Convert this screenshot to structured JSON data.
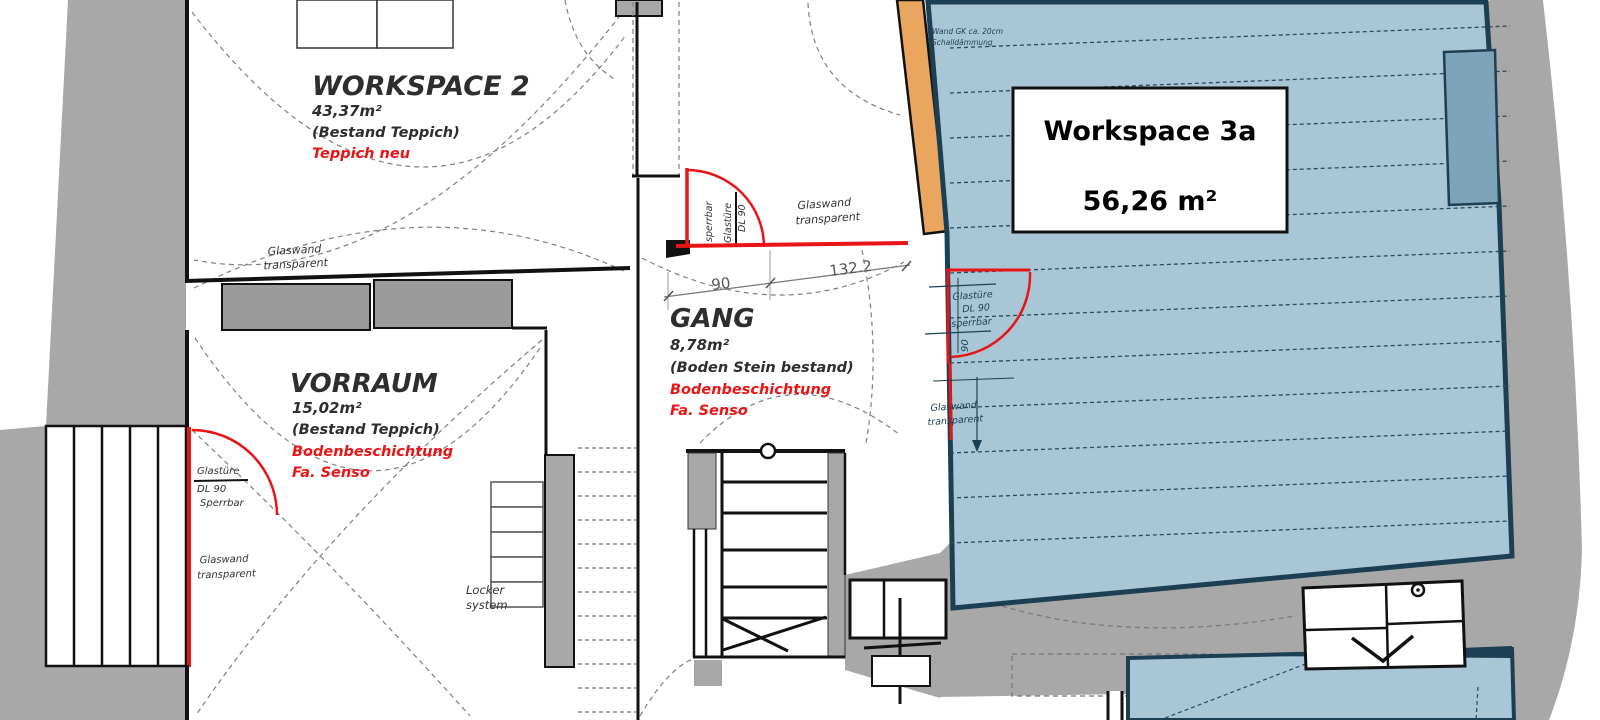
{
  "plan": {
    "rooms": {
      "workspace2": {
        "name": "WORKSPACE 2",
        "area": "43,37m²",
        "floor_existing": "(Bestand Teppich)",
        "floor_new": "Teppich neu"
      },
      "vorraum": {
        "name": "VORRAUM",
        "area": "15,02m²",
        "floor_existing": "(Bestand Teppich)",
        "floor_new1": "Bodenbeschichtung",
        "floor_new2": "Fa. Senso"
      },
      "gang": {
        "name": "GANG",
        "area": "8,78m²",
        "floor_existing": "(Boden Stein bestand)",
        "floor_new1": "Bodenbeschichtung",
        "floor_new2": "Fa. Senso"
      },
      "workspace3a": {
        "name": "Workspace 3a",
        "area": "56,26 m²"
      }
    },
    "doors": {
      "vorraum_door": {
        "line1": "Glastüre",
        "line2": "DL 90",
        "line3": "Sperrbar"
      },
      "gang_door": {
        "line1": "Glastüre",
        "line2": "DL 90",
        "line3": "sperrbar"
      },
      "workspace3a_door": {
        "line1": "Glastüre",
        "line2": "DL 90",
        "line3": "sperrbar"
      }
    },
    "glass_walls": {
      "line1": "Glaswand",
      "line2": "transparent"
    },
    "wall_note": {
      "line1": "Wand GK ca. 20cm",
      "line2": "Schalldämmung"
    },
    "locker": {
      "line1": "Locker",
      "line2": "system"
    },
    "dimensions": {
      "gang_width1": "90",
      "gang_width2": "132.2",
      "door_width": "90"
    },
    "colors": {
      "red": "#e81416",
      "orange": "#eaa55e",
      "blue_fill": "#a9c6d6",
      "blue_dark": "#7da4b8",
      "navy": "#1d3f54",
      "gray": "#a8a8a8"
    }
  }
}
